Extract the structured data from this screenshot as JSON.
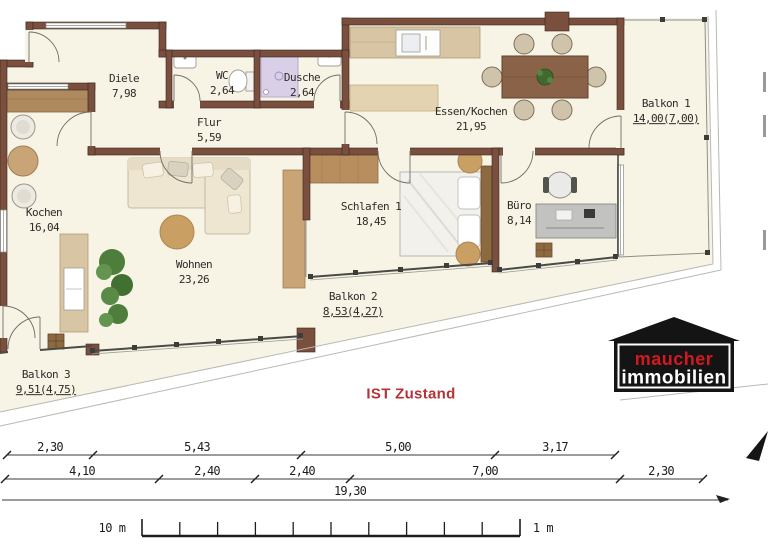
{
  "status_label": "IST Zustand",
  "rooms": [
    {
      "name": "Diele",
      "area": "7,98"
    },
    {
      "name": "WC",
      "area": "2,64"
    },
    {
      "name": "Dusche",
      "area": "2,64"
    },
    {
      "name": "Flur",
      "area": "5,59"
    },
    {
      "name": "Essen/Kochen",
      "area": "21,95"
    },
    {
      "name": "Balkon 1",
      "area": "14,00(7,00)"
    },
    {
      "name": "Kochen",
      "area": "16,04"
    },
    {
      "name": "Wohnen",
      "area": "23,26"
    },
    {
      "name": "Schlafen 1",
      "area": "18,45"
    },
    {
      "name": "Büro",
      "area": "8,14"
    },
    {
      "name": "Balkon 2",
      "area": "8,53(4,27)"
    },
    {
      "name": "Balkon 3",
      "area": "9,51(4,75)"
    }
  ],
  "dimensions": {
    "row1": [
      "2,30",
      "5,43",
      "5,00",
      "3,17"
    ],
    "row2": [
      "4,10",
      "2,40",
      "2,40",
      "7,00",
      "2,30"
    ],
    "total": "19,30"
  },
  "scale_bar": {
    "left_label": "10 m",
    "right_label": "1 m"
  },
  "logo": {
    "line1": "maucher",
    "line2": "immobilien"
  },
  "colors": {
    "wall": "#7a4f3e",
    "floor": "#f7f4e6",
    "accent_red": "#b23338",
    "logo_red": "#d2191f",
    "logo_black": "#141414",
    "wood": "#c19a6b"
  }
}
